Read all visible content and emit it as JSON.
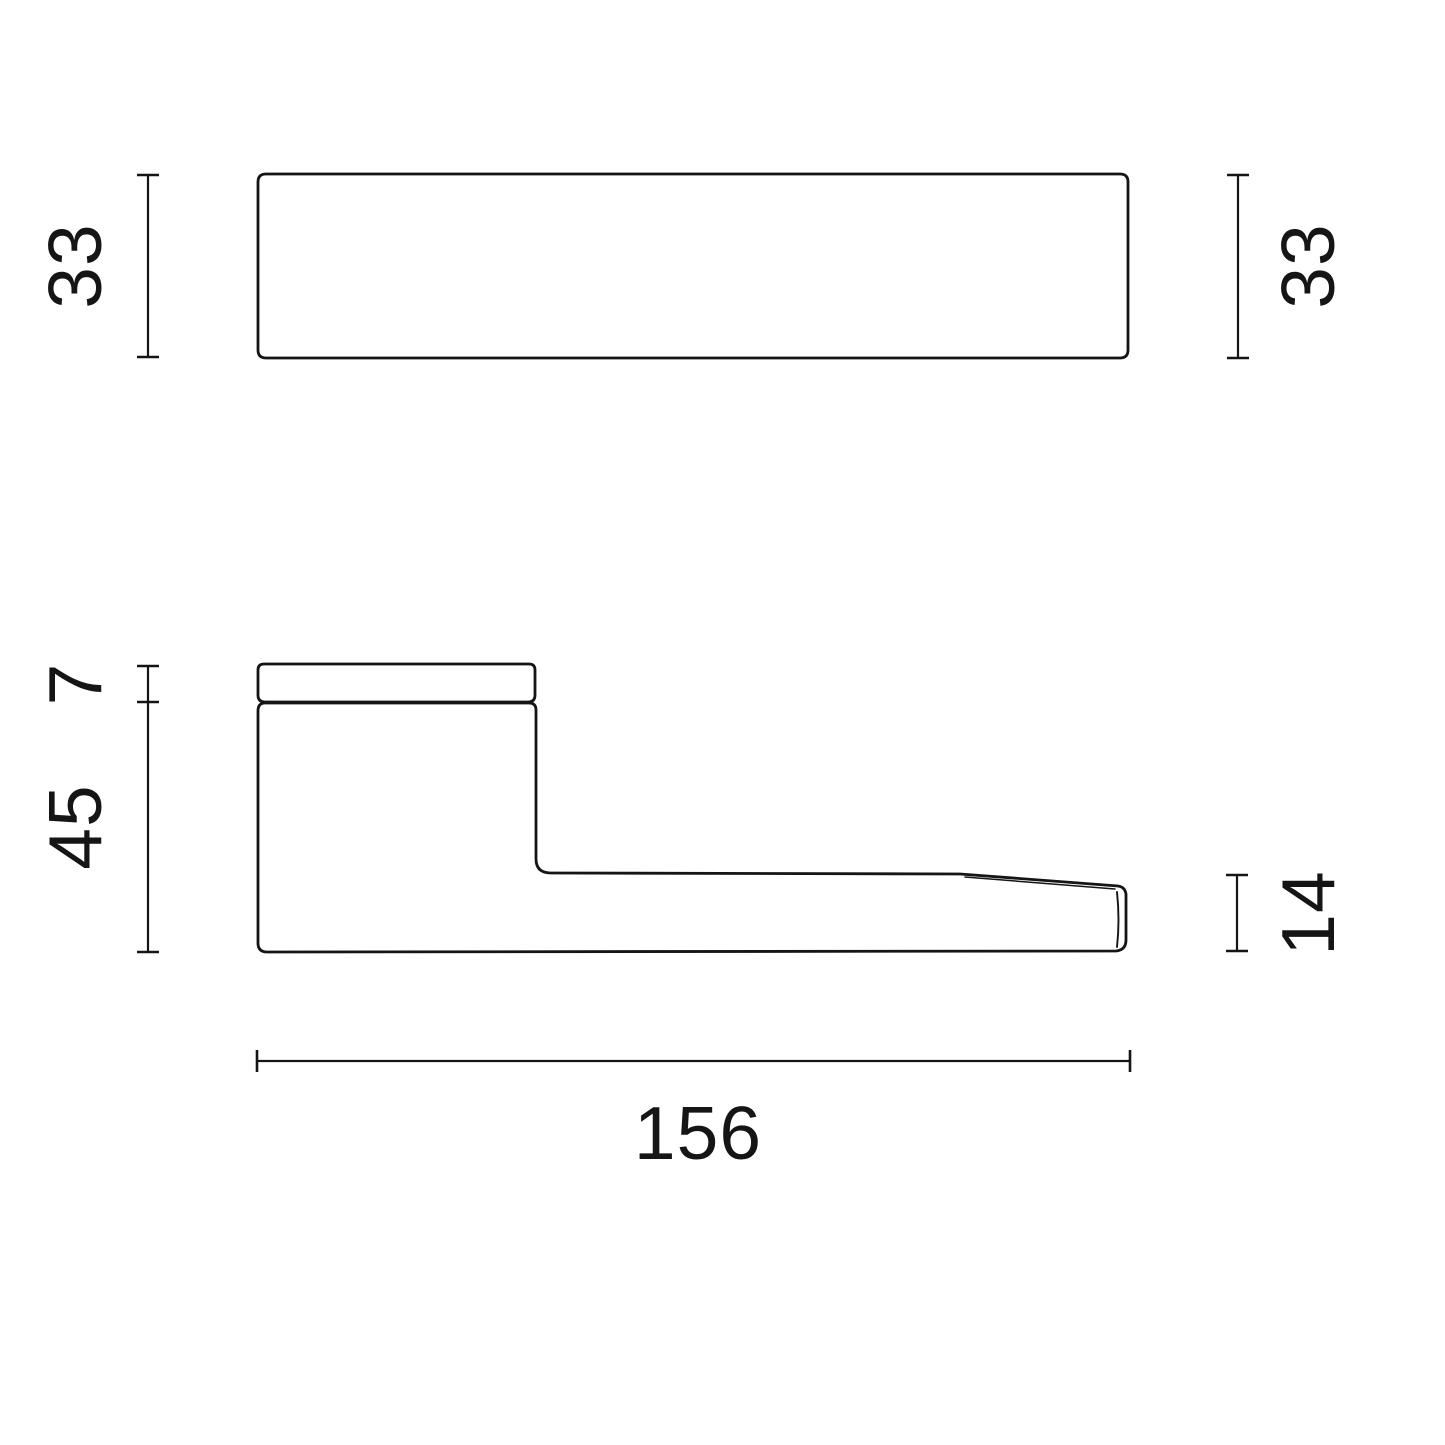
{
  "drawing": {
    "kind": "technical-dimension-drawing",
    "subject": "door lever handle, two orthographic views",
    "background_color": "#ffffff",
    "line_color": "#151515",
    "views": [
      {
        "id": "top-view",
        "description": "plan view of handle bar, rounded rectangle"
      },
      {
        "id": "side-view",
        "description": "side profile: rose cap, grip block and tapered lever arm"
      }
    ]
  },
  "dimensions": {
    "top_height_left": "33",
    "top_height_right": "33",
    "cap_thickness": "7",
    "block_height": "45",
    "lever_tip_height": "14",
    "overall_length": "156"
  }
}
